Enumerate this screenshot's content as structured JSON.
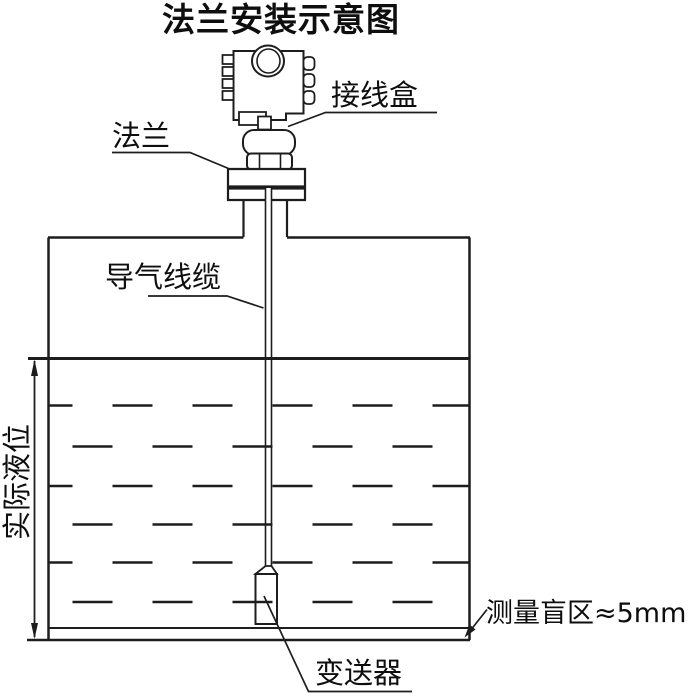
{
  "title": "法兰安装示意图",
  "labels": {
    "junction_box": "接线盒",
    "flange": "法兰",
    "air_cable": "导气线缆",
    "actual_level": "实际液位",
    "transmitter": "变送器",
    "blind_zone": "测量盲区≈5mm"
  },
  "colors": {
    "line": "#1d1d1d",
    "background": "#ffffff",
    "text": "#0e0e0e"
  }
}
